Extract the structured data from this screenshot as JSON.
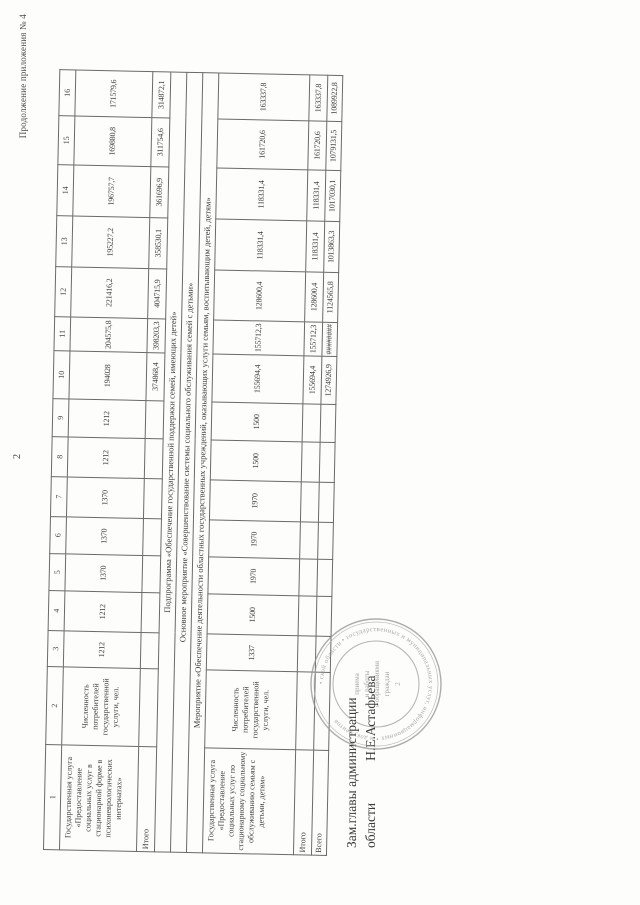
{
  "page": {
    "continuation_note": "Продолжение приложения № 4",
    "page_number": "2"
  },
  "table": {
    "column_numbers": [
      "1",
      "2",
      "3",
      "4",
      "5",
      "6",
      "7",
      "8",
      "9",
      "10",
      "11",
      "12",
      "13",
      "14",
      "15",
      "16"
    ],
    "row1": {
      "name": "Государственная услуга «Предоставление социальных услуг в стационарной форме в психоневрологических интернатах»",
      "indicator": "Численность потребителей государственной услуги, чел.",
      "v": [
        "1212",
        "1212",
        "1370",
        "1370",
        "1370",
        "1212",
        "1212",
        "194028",
        "204575,8",
        "221416,2",
        "195227,2",
        "196757,7",
        "169880,8",
        "171579,6"
      ]
    },
    "itogo1": {
      "label": "Итого",
      "v": [
        "374868,4",
        "398203,3",
        "404715,9",
        "358530,1",
        "361696,9",
        "311754,6",
        "314872,1"
      ]
    },
    "sections": [
      "Подпрограмма «Обеспечение государственной поддержки семей, имеющих детей»",
      "Основное мероприятие «Совершенствование системы социального обслуживания семей с детьми»",
      "Мероприятие «Обеспечение деятельности областных государственных учреждений, оказывающих услуги семьям, воспитывающим детей, детям»"
    ],
    "row2": {
      "name": "Государственная услуга «Предоставление социальных услуг по стационарному социальному обслуживанию семьям с детьми, детям»",
      "indicator": "Численность потребителей государственной услуги, чел.",
      "v": [
        "1337",
        "1500",
        "1970",
        "1970",
        "1970",
        "1500",
        "1500",
        "155694,4",
        "155712,3",
        "128600,4",
        "118331,4",
        "118331,4",
        "161720,6",
        "163337,8"
      ]
    },
    "itogo2": {
      "label": "Итого",
      "v": [
        "155694,4",
        "155712,3",
        "128600,4",
        "118331,4",
        "118331,4",
        "161720,6",
        "163337,8"
      ]
    },
    "vsego": {
      "label": "Всего",
      "v": [
        "1274926,9",
        "########",
        "1124565,8",
        "1013863,3",
        "1017030,1",
        "1079131,5",
        "1089922,8"
      ]
    }
  },
  "signature": {
    "line1": "Зам.главы администрации",
    "line2": "области",
    "name": "Н.Е.Астафьева"
  },
  "stamp": {
    "ring_text": "• ской области • государственных и муниципальных услуг, информационных • и документов",
    "center_lines": [
      "приема",
      "и работы",
      "с обращениями",
      "граждан",
      "2"
    ]
  }
}
